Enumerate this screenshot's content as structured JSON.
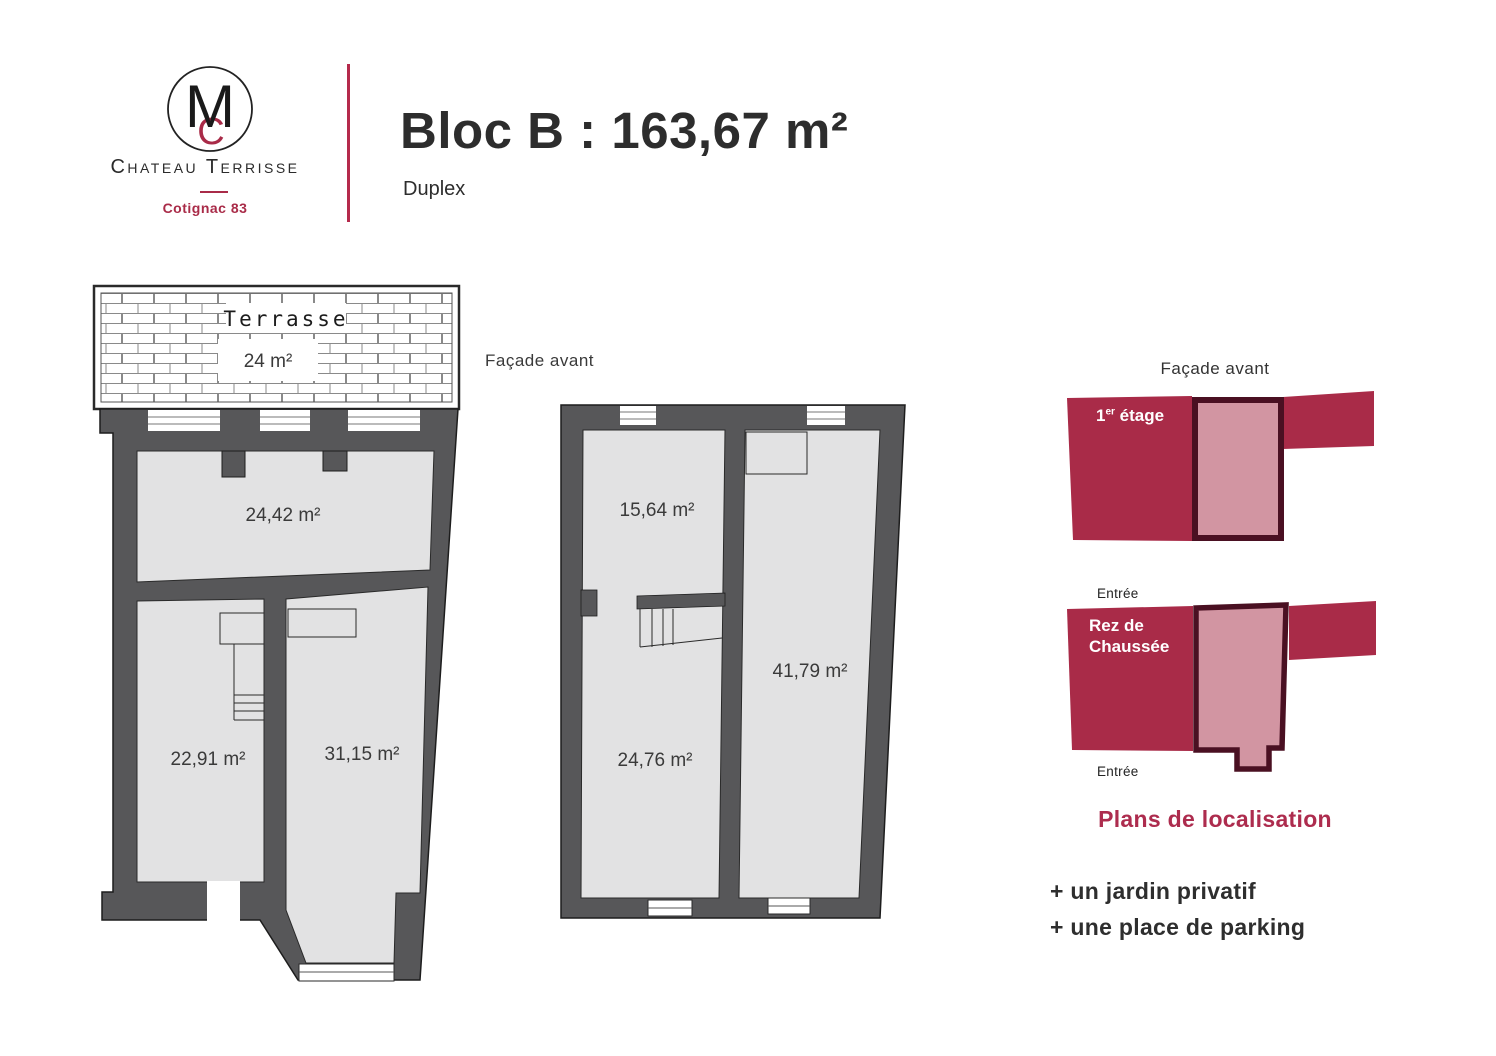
{
  "header": {
    "monogram_front": "M",
    "monogram_back": "C",
    "brand": "Chateau Terrisse",
    "location": "Cotignac 83",
    "title": "Bloc B : 163,67 m²",
    "subtitle": "Duplex"
  },
  "plans": {
    "facade_front_label": "Façade avant",
    "terrace": {
      "label": "Terrasse",
      "area": "24 m²"
    },
    "floor_with_terrace": {
      "room_top": "24,42 m²",
      "room_bottom_left": "22,91 m²",
      "room_bottom_right": "31,15 m²"
    },
    "other_floor": {
      "room_top_left": "15,64 m²",
      "room_right": "41,79 m²",
      "room_bottom_left": "24,76 m²"
    }
  },
  "location_plans": {
    "title": "Façade avant",
    "first_floor": {
      "num": "1",
      "sup": "er",
      "rest": " étage"
    },
    "ground_floor": {
      "line1": "Rez de",
      "line2": "Chaussée"
    },
    "entrance_top": "Entrée",
    "entrance_bottom": "Entrée",
    "caption": "Plans de localisation"
  },
  "amenities": {
    "item1": "+ un jardin privatif",
    "item2": "+ une place de parking"
  },
  "colors": {
    "crimson": "#a92b48",
    "pink": "#d295a2",
    "maroon": "#4a1022",
    "wall_gray": "#575759",
    "floor_gray": "#e2e2e3"
  }
}
